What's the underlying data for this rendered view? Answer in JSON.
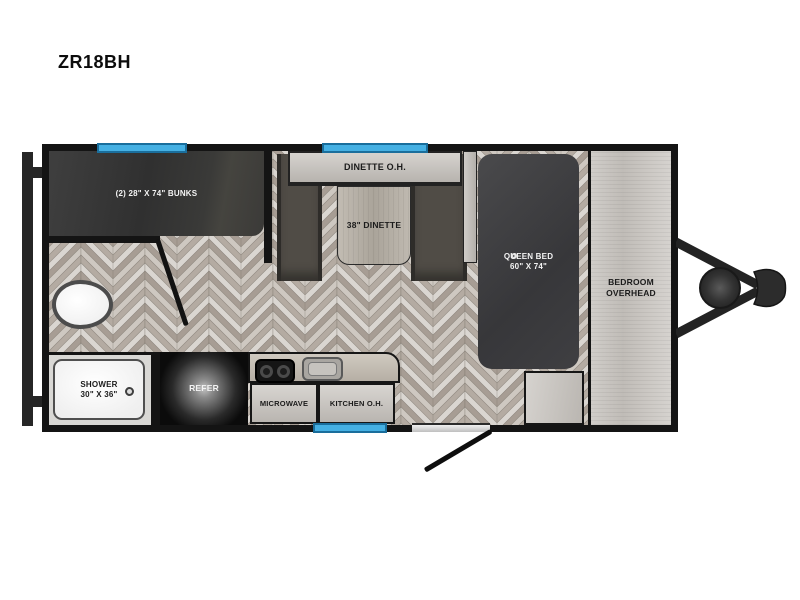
{
  "title": "ZR18BH",
  "colors": {
    "window_blue": "#45b0e3",
    "wall_black": "#141414",
    "furniture_dark": "#3c3c3e",
    "cabinet_light": "#ccc8c3",
    "floor_tone_1": "#cec8c1",
    "floor_tone_2": "#b4aba2",
    "floor_tone_3": "#dad6d1",
    "floor_tone_4": "#a79d94"
  },
  "rooms": {
    "bunks": {
      "label": "(2) 28\" X 74\" BUNKS"
    },
    "dinette_overhead": {
      "label": "DINETTE O.H."
    },
    "dinette_table": {
      "label": "38\" DINETTE"
    },
    "queen_bed": {
      "line1": "QUEEN BED",
      "line2": "60\" X 74\""
    },
    "bedroom_overhead": {
      "line1": "BEDROOM",
      "line2": "OVERHEAD"
    },
    "shower": {
      "line1": "SHOWER",
      "line2": "30\" X 36\""
    },
    "refer": {
      "label": "REFER"
    },
    "microwave": {
      "label": "MICROWAVE"
    },
    "kitchen_overhead": {
      "label": "KITCHEN O.H."
    }
  }
}
